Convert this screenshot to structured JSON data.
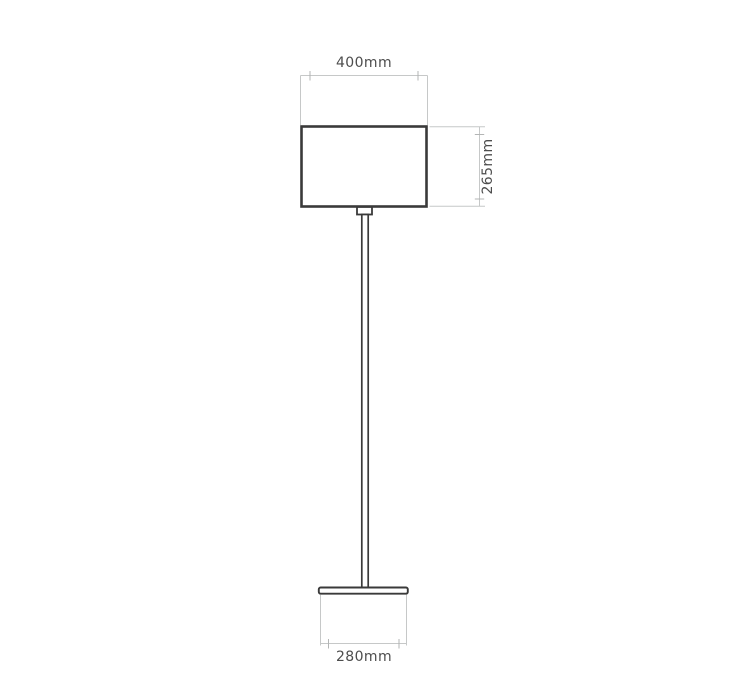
{
  "diagram": {
    "title": "floor-lamp-dimension-drawing",
    "dimensions": {
      "shade_width": {
        "label": "400mm",
        "orientation": "horizontal",
        "position": "top"
      },
      "shade_height": {
        "label": "265mm",
        "orientation": "vertical",
        "position": "right"
      },
      "base_width": {
        "label": "280mm",
        "orientation": "horizontal",
        "position": "bottom"
      }
    },
    "parts": [
      "lampshade",
      "collar",
      "stem",
      "base"
    ],
    "colors": {
      "outline": "#3a3a3a",
      "fill": "#ffffff",
      "dimension_line": "#c6c8c8",
      "tick": "#b3b5b5",
      "label_text": "#4d4d4d",
      "background": "#ffffff"
    }
  }
}
